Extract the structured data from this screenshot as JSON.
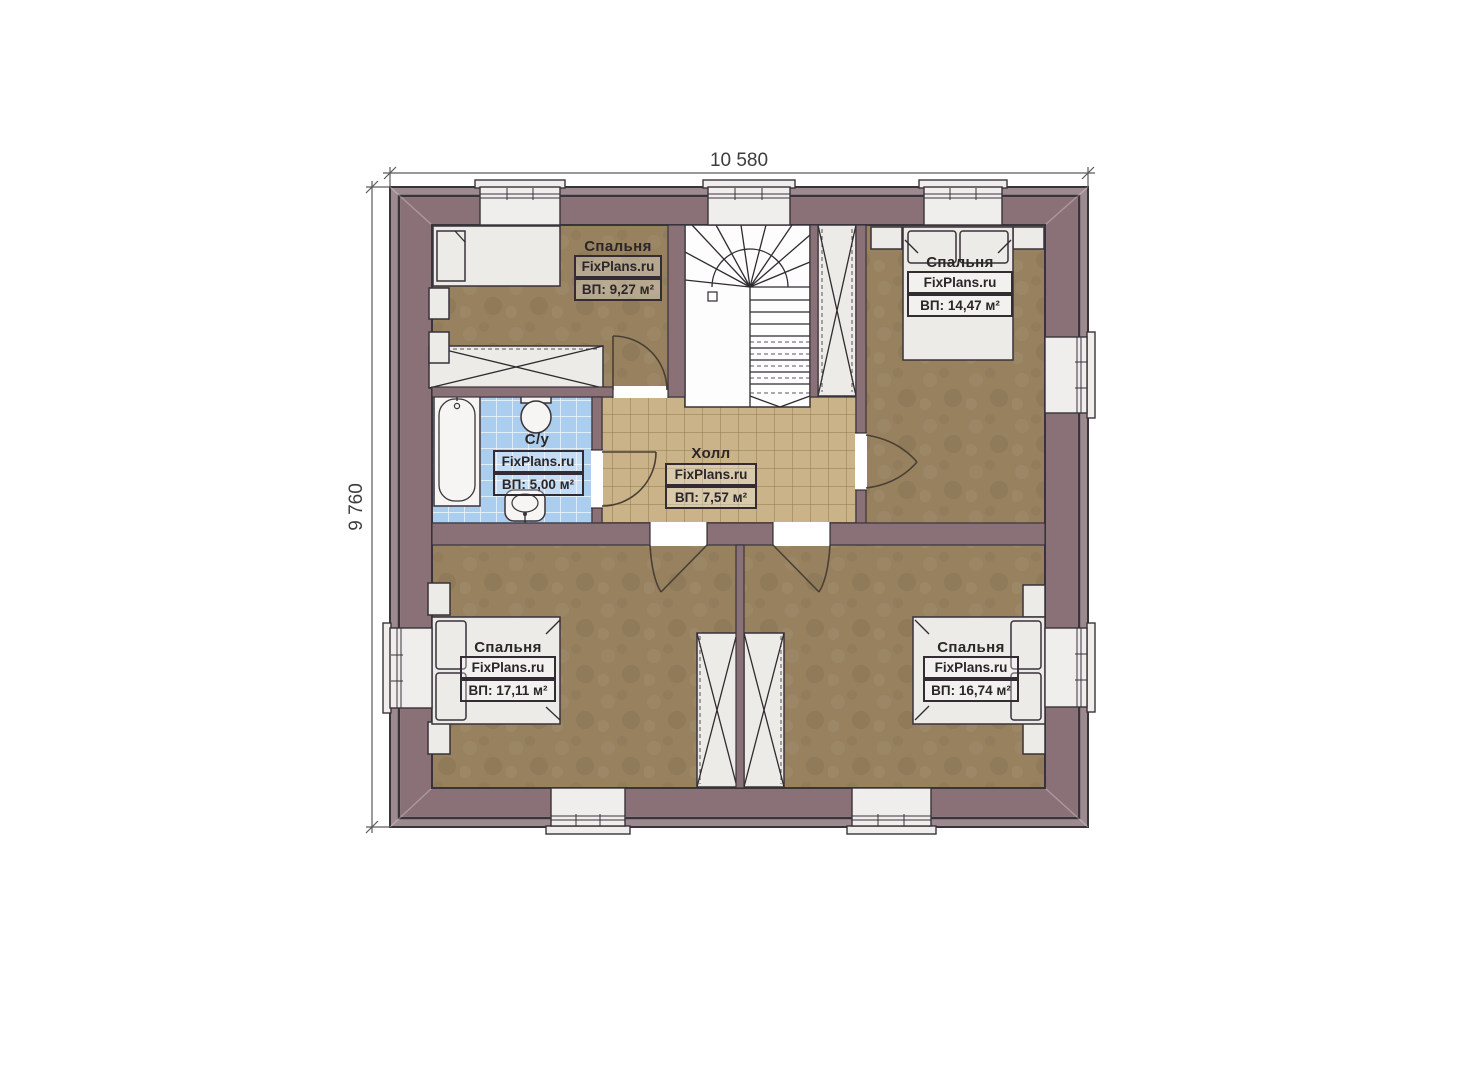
{
  "plan": {
    "dimensions": {
      "width_label": "10 580",
      "height_label": "9 760"
    },
    "rooms": {
      "bedroom_tl": {
        "name": "Спальня",
        "brand": "FixPlans.ru",
        "area": "ВП: 9,27 м²"
      },
      "bedroom_tr": {
        "name": "Спальня",
        "brand": "FixPlans.ru",
        "area": "ВП: 14,47 м²"
      },
      "bathroom": {
        "name": "С/у",
        "brand": "FixPlans.ru",
        "area": "ВП: 5,00 м²"
      },
      "hall": {
        "name": "Холл",
        "brand": "FixPlans.ru",
        "area": "ВП: 7,57 м²"
      },
      "bedroom_bl": {
        "name": "Спальня",
        "brand": "FixPlans.ru",
        "area": "ВП: 17,11 м²"
      },
      "bedroom_br": {
        "name": "Спальня",
        "brand": "FixPlans.ru",
        "area": "ВП: 16,74 м²"
      }
    },
    "colors": {
      "wall": "#8a7177",
      "wall_outer": "#9d8a8f",
      "floor": "#97815f",
      "hall_tile": "#cbb389",
      "bath_tile": "#abceef",
      "outline": "#39333a"
    }
  }
}
